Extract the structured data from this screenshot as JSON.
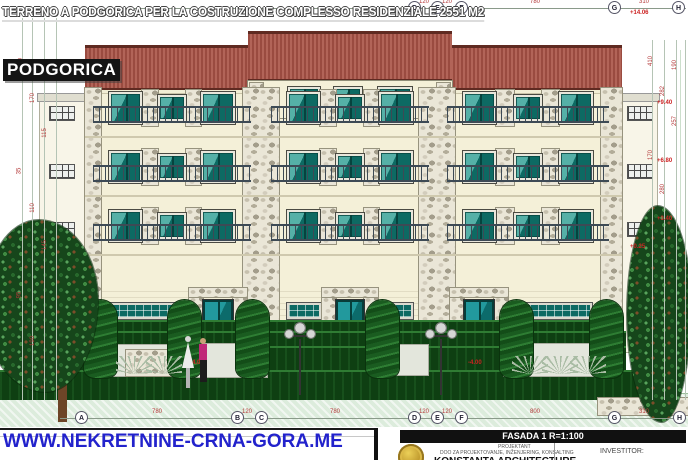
{
  "overlays": {
    "banner": "TERRENO A PODGORICA PER LA COSTRUZIONE COMPLESSO RESIDENZIALE 2551 M2",
    "city": "PODGORICA",
    "url": "WWW.NEKRETNINE-CRNA-GORA.ME"
  },
  "title_block": {
    "drawing": "FASADA 1 R=1:100",
    "role_label": "PROJEKTANT",
    "company_sub": "DOO ZA PROJEKTOVANJE, INŽENJERING, KONSALTING",
    "company": "KONSTANTA ARCHITECTURE",
    "investor_label": "INVESTITOR:"
  },
  "grid": {
    "top_line": {
      "x1": 80,
      "x2": 686,
      "y": 8
    },
    "bottom_line": {
      "x1": 60,
      "x2": 686,
      "y": 418
    },
    "top_bubbles": [
      {
        "label": "D",
        "x": 415
      },
      {
        "label": "E",
        "x": 438
      },
      {
        "label": "F",
        "x": 462
      },
      {
        "label": "G",
        "x": 615
      },
      {
        "label": "H",
        "x": 679
      }
    ],
    "bottom_bubbles": [
      {
        "label": "A",
        "x": 82
      },
      {
        "label": "B",
        "x": 238
      },
      {
        "label": "C",
        "x": 262
      },
      {
        "label": "D",
        "x": 415
      },
      {
        "label": "E",
        "x": 438
      },
      {
        "label": "F",
        "x": 462
      },
      {
        "label": "G",
        "x": 615
      },
      {
        "label": "H",
        "x": 680
      }
    ]
  },
  "dims": {
    "top": [
      {
        "v": "120",
        "x": 427
      },
      {
        "v": "120",
        "x": 450
      },
      {
        "v": "780",
        "x": 538
      },
      {
        "v": "310",
        "x": 647
      }
    ],
    "bottom": [
      {
        "v": "780",
        "x": 160
      },
      {
        "v": "120",
        "x": 250
      },
      {
        "v": "780",
        "x": 338
      },
      {
        "v": "120",
        "x": 427
      },
      {
        "v": "120",
        "x": 450
      },
      {
        "v": "800",
        "x": 538
      },
      {
        "v": "310",
        "x": 647
      }
    ],
    "left_lines_x": [
      22,
      32,
      44,
      56
    ],
    "right_lines_x": [
      652,
      664,
      676,
      685
    ],
    "left": [
      {
        "v": "280",
        "x": 22,
        "y": 60
      },
      {
        "v": "170",
        "x": 34,
        "y": 95
      },
      {
        "v": "115",
        "x": 46,
        "y": 130
      },
      {
        "v": "35",
        "x": 22,
        "y": 168
      },
      {
        "v": "110",
        "x": 34,
        "y": 205
      },
      {
        "v": "145",
        "x": 46,
        "y": 242
      },
      {
        "v": "95",
        "x": 22,
        "y": 292
      },
      {
        "v": "190",
        "x": 34,
        "y": 338
      }
    ],
    "right": [
      {
        "v": "410",
        "x": 652,
        "y": 58
      },
      {
        "v": "282",
        "x": 664,
        "y": 88
      },
      {
        "v": "257",
        "x": 676,
        "y": 118
      },
      {
        "v": "170",
        "x": 652,
        "y": 152
      },
      {
        "v": "280",
        "x": 664,
        "y": 186
      },
      {
        "v": "190",
        "x": 676,
        "y": 62
      }
    ]
  },
  "elevations": [
    {
      "v": "+14.06",
      "x": 630,
      "y": 10
    },
    {
      "v": "+9.40",
      "x": 657,
      "y": 100
    },
    {
      "v": "+6.80",
      "x": 657,
      "y": 158
    },
    {
      "v": "+3.40",
      "x": 657,
      "y": 216
    },
    {
      "v": "+0.25",
      "x": 630,
      "y": 244
    },
    {
      "v": "-4.00",
      "x": 190,
      "y": 360
    },
    {
      "v": "-4.00",
      "x": 468,
      "y": 360
    }
  ],
  "colors": {
    "roof": "#a5574c",
    "wall": "#f4f0d8",
    "window_dark": "#0c6660",
    "window_light": "#55b0a7",
    "hedge": "#0e3f12",
    "ground": "#dcecdc",
    "stone": "#eae6d7",
    "url_blue": "#2222cc",
    "dim_red": "#b43a3a",
    "seal_gold": "#c09a2e"
  },
  "building": {
    "wall": {
      "x": 85,
      "y": 88,
      "w": 537,
      "h": 264
    },
    "roof": {
      "x": 85,
      "y": 45,
      "w": 537,
      "h": 45
    },
    "tower": {
      "x": 248,
      "y": 31,
      "w": 204,
      "roof_h": 50,
      "win_y": 87,
      "win_h": 27,
      "windows": [
        {
          "x": 288,
          "w": 32
        },
        {
          "x": 334,
          "w": 28
        },
        {
          "x": 378,
          "w": 34
        }
      ],
      "stones": [
        {
          "x": 250,
          "y": 83,
          "w": 13,
          "h": 35
        },
        {
          "x": 437,
          "y": 83,
          "w": 13,
          "h": 35
        }
      ]
    },
    "floors_y": [
      92,
      151,
      210
    ],
    "bays": [
      {
        "x": 101,
        "w": 142
      },
      {
        "x": 279,
        "w": 142
      },
      {
        "x": 455,
        "w": 146
      }
    ],
    "pilasters": [
      {
        "x": 85,
        "w": 16
      },
      {
        "x": 243,
        "w": 36
      },
      {
        "x": 419,
        "w": 36
      },
      {
        "x": 601,
        "w": 21
      }
    ],
    "ground": {
      "ribbon_y": 303,
      "ribbon_h": 16,
      "ribbons": [
        {
          "x": 109,
          "w": 70
        },
        {
          "x": 287,
          "w": 34
        },
        {
          "x": 377,
          "w": 36
        },
        {
          "x": 512,
          "w": 80
        }
      ],
      "door_y": 300,
      "door_h": 50,
      "doors": [
        {
          "x": 203,
          "w": 30
        },
        {
          "x": 336,
          "w": 28
        },
        {
          "x": 464,
          "w": 30
        }
      ]
    },
    "wings": {
      "left": {
        "x": 40,
        "w": 45
      },
      "right": {
        "x": 622,
        "w": 35
      },
      "cap_y": 94,
      "win_rows": [
        106,
        164,
        222
      ],
      "win_w": 26,
      "win_h": 15,
      "left_win_x": 49,
      "right_win_x": 627
    }
  },
  "scenery": {
    "hedges": [
      {
        "x": 96,
        "y": 320,
        "w": 526,
        "h": 13
      },
      {
        "x": 60,
        "y": 331,
        "w": 566,
        "h": 17
      },
      {
        "x": 24,
        "y": 346,
        "w": 602,
        "h": 24
      },
      {
        "x": 0,
        "y": 370,
        "w": 648,
        "h": 30
      }
    ],
    "pavements": [
      {
        "x": 110,
        "y": 345,
        "w": 72,
        "h": 31
      },
      {
        "x": 183,
        "y": 344,
        "w": 84,
        "h": 33
      },
      {
        "x": 388,
        "y": 345,
        "w": 40,
        "h": 30
      },
      {
        "x": 504,
        "y": 344,
        "w": 96,
        "h": 32
      }
    ],
    "stone_walls": [
      {
        "x": 12,
        "y": 350,
        "w": 48,
        "h": 26
      },
      {
        "x": 126,
        "y": 350,
        "w": 58,
        "h": 26
      },
      {
        "x": 598,
        "y": 398,
        "w": 90,
        "h": 17
      }
    ],
    "topiaries": [
      {
        "x": 84
      },
      {
        "x": 168
      },
      {
        "x": 236
      },
      {
        "x": 366
      },
      {
        "x": 500
      },
      {
        "x": 590
      }
    ],
    "topiary_y": 300,
    "topiary_w": 33,
    "topiary_h": 78,
    "lamps": [
      {
        "x": 283
      },
      {
        "x": 424
      }
    ],
    "lamp_y": 323,
    "agaves": [
      {
        "x": 116
      },
      {
        "x": 146
      },
      {
        "x": 512
      },
      {
        "x": 542
      },
      {
        "x": 570
      }
    ],
    "agave_y": 356,
    "trees": [
      {
        "x": -16,
        "y": 220,
        "w": 114,
        "h": 172
      },
      {
        "x": 627,
        "y": 206,
        "w": 64,
        "h": 216
      }
    ],
    "trunk": {
      "x": 58,
      "y": 376,
      "w": 9,
      "h": 46
    },
    "grid_lines_x": [
      152,
      218,
      296,
      332,
      415,
      438,
      462,
      540,
      615,
      680
    ],
    "ground_strip": {
      "y": 393,
      "h": 34
    }
  }
}
